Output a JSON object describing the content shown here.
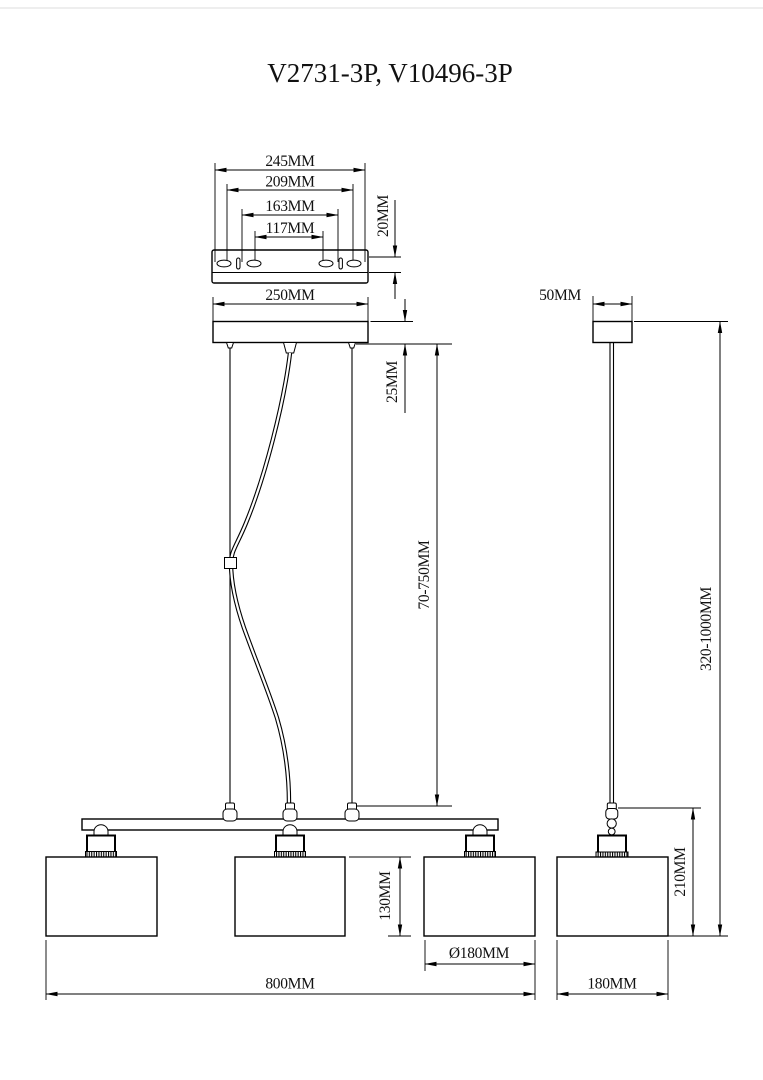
{
  "title": "V2731-3P, V10496-3P",
  "front_view": {
    "mounting_bracket": {
      "hole_spacing_outer": "245MM",
      "hole_spacing_2": "209MM",
      "hole_spacing_3": "163MM",
      "hole_spacing_inner": "117MM",
      "height": "20MM"
    },
    "canopy": {
      "width": "250MM",
      "height": "25MM"
    },
    "cable": {
      "adjustable_drop": "70-750MM"
    },
    "shade": {
      "height": "130MM",
      "diameter": "Ø180MM"
    },
    "overall_width": "800MM"
  },
  "side_view": {
    "canopy_width": "50MM",
    "overall_drop": "320-1000MM",
    "pendant_height": "210MM",
    "shade_width": "180MM"
  }
}
